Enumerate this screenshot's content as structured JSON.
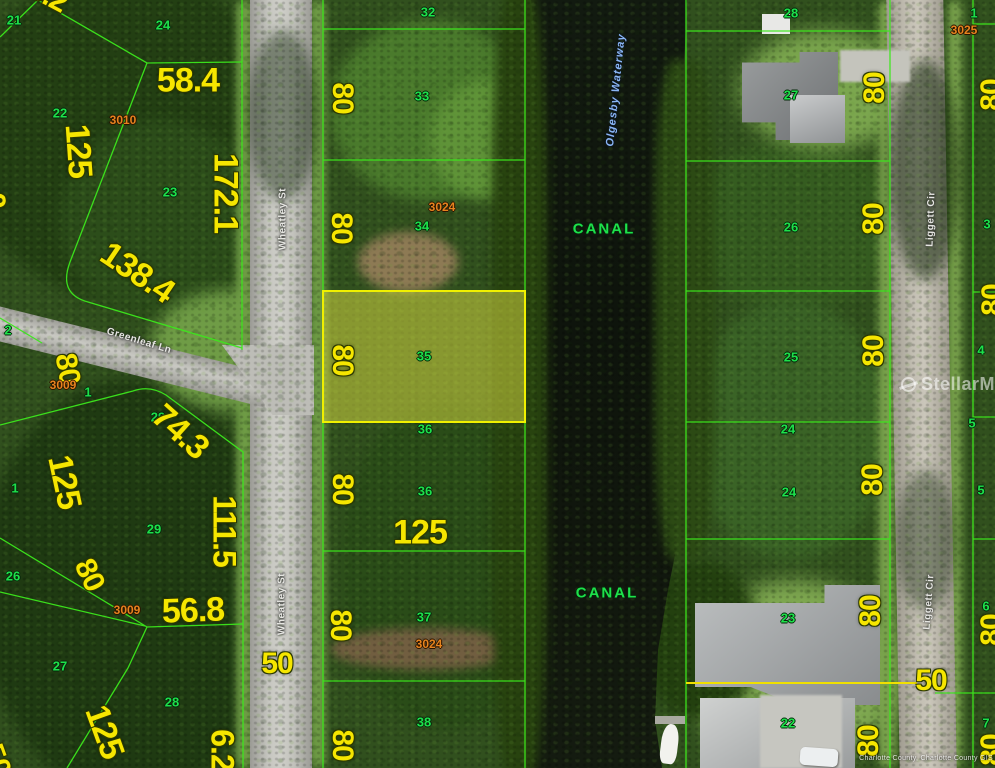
{
  "map": {
    "title": "aerial parcel map",
    "watermark": {
      "text": "StellarMLS"
    },
    "attribution": "Charlotte County, Charlotte County GIS",
    "waterway_name": "Olgesby Waterway",
    "highlight": {
      "lot": "35",
      "fill": "#e8e846",
      "border": "#f0f000"
    },
    "colors": {
      "dimension_text": "#f6e600",
      "lot_number_text": "#1de14b",
      "parcel_id_text": "#e6831e",
      "boundary_line": "#3ce81c",
      "highlight_line": "#f0e000",
      "waterway_text": "#8ab5f5"
    },
    "streets": [
      {
        "name": "Wheatley St"
      },
      {
        "name": "Greenleaf Ln"
      },
      {
        "name": "Liggett Cir"
      }
    ],
    "labels": [
      {
        "t": "21",
        "x": 14,
        "y": 20,
        "r": 0,
        "c": "lot"
      },
      {
        "t": "24",
        "x": 163,
        "y": 25,
        "r": 0,
        "c": "lot"
      },
      {
        "t": "22",
        "x": 60,
        "y": 113,
        "r": 0,
        "c": "lot"
      },
      {
        "t": "23",
        "x": 170,
        "y": 192,
        "r": 0,
        "c": "lot"
      },
      {
        "t": "2",
        "x": 8,
        "y": 330,
        "r": 0,
        "c": "lot"
      },
      {
        "t": "1",
        "x": 88,
        "y": 392,
        "r": 0,
        "c": "lot"
      },
      {
        "t": "29",
        "x": 158,
        "y": 417,
        "r": 0,
        "c": "lot"
      },
      {
        "t": "1",
        "x": 15,
        "y": 488,
        "r": 0,
        "c": "lot"
      },
      {
        "t": "29",
        "x": 154,
        "y": 529,
        "r": 0,
        "c": "lot"
      },
      {
        "t": "26",
        "x": 13,
        "y": 576,
        "r": 0,
        "c": "lot"
      },
      {
        "t": "27",
        "x": 60,
        "y": 666,
        "r": 0,
        "c": "lot"
      },
      {
        "t": "28",
        "x": 172,
        "y": 702,
        "r": 0,
        "c": "lot"
      },
      {
        "t": "32",
        "x": 428,
        "y": 12,
        "r": 0,
        "c": "lot"
      },
      {
        "t": "33",
        "x": 422,
        "y": 96,
        "r": 0,
        "c": "lot"
      },
      {
        "t": "34",
        "x": 422,
        "y": 226,
        "r": 0,
        "c": "lot"
      },
      {
        "t": "35",
        "x": 424,
        "y": 356,
        "r": 0,
        "c": "lot"
      },
      {
        "t": "36",
        "x": 425,
        "y": 429,
        "r": 0,
        "c": "lot"
      },
      {
        "t": "36",
        "x": 425,
        "y": 491,
        "r": 0,
        "c": "lot"
      },
      {
        "t": "37",
        "x": 424,
        "y": 617,
        "r": 0,
        "c": "lot"
      },
      {
        "t": "38",
        "x": 424,
        "y": 722,
        "r": 0,
        "c": "lot"
      },
      {
        "t": "28",
        "x": 791,
        "y": 13,
        "r": 0,
        "c": "lot"
      },
      {
        "t": "27",
        "x": 791,
        "y": 95,
        "r": 0,
        "c": "lot"
      },
      {
        "t": "26",
        "x": 791,
        "y": 227,
        "r": 0,
        "c": "lot"
      },
      {
        "t": "25",
        "x": 791,
        "y": 357,
        "r": 0,
        "c": "lot"
      },
      {
        "t": "24",
        "x": 788,
        "y": 429,
        "r": 0,
        "c": "lot"
      },
      {
        "t": "24",
        "x": 789,
        "y": 492,
        "r": 0,
        "c": "lot"
      },
      {
        "t": "23",
        "x": 788,
        "y": 618,
        "r": 0,
        "c": "lot"
      },
      {
        "t": "22",
        "x": 788,
        "y": 723,
        "r": 0,
        "c": "lot"
      },
      {
        "t": "1",
        "x": 974,
        "y": 13,
        "r": 0,
        "c": "lot"
      },
      {
        "t": "2",
        "x": 988,
        "y": 92,
        "r": 0,
        "c": "lot"
      },
      {
        "t": "3",
        "x": 987,
        "y": 224,
        "r": 0,
        "c": "lot"
      },
      {
        "t": "4",
        "x": 981,
        "y": 350,
        "r": 0,
        "c": "lot"
      },
      {
        "t": "5",
        "x": 972,
        "y": 423,
        "r": 0,
        "c": "lot"
      },
      {
        "t": "5",
        "x": 981,
        "y": 490,
        "r": 0,
        "c": "lot"
      },
      {
        "t": "6",
        "x": 986,
        "y": 606,
        "r": 0,
        "c": "lot"
      },
      {
        "t": "7",
        "x": 986,
        "y": 723,
        "r": 0,
        "c": "lot"
      },
      {
        "t": "5.2",
        "x": 48,
        "y": -4,
        "r": 28,
        "c": "dim",
        "s": 30
      },
      {
        "t": "58.4",
        "x": 188,
        "y": 81,
        "r": 0,
        "c": "dim",
        "s": 34
      },
      {
        "t": "125",
        "x": 78,
        "y": 151,
        "r": 86,
        "c": "dim",
        "s": 34
      },
      {
        "t": "172.1",
        "x": 225,
        "y": 193,
        "r": 90,
        "c": "dim",
        "s": 34
      },
      {
        "t": "138.4",
        "x": 137,
        "y": 273,
        "r": 34,
        "c": "dim",
        "s": 34
      },
      {
        "t": "0",
        "x": -6,
        "y": 200,
        "r": 90,
        "c": "dim",
        "s": 30
      },
      {
        "t": "80",
        "x": 67,
        "y": 369,
        "r": 80,
        "c": "dim",
        "s": 30
      },
      {
        "t": "74.3",
        "x": 180,
        "y": 432,
        "r": 42,
        "c": "dim",
        "s": 34
      },
      {
        "t": "125",
        "x": 64,
        "y": 482,
        "r": 78,
        "c": "dim",
        "s": 34
      },
      {
        "t": "111.5",
        "x": 224,
        "y": 531,
        "r": 90,
        "c": "dim",
        "s": 32
      },
      {
        "t": "80",
        "x": 89,
        "y": 575,
        "r": 64,
        "c": "dim",
        "s": 30
      },
      {
        "t": "56.8",
        "x": 193,
        "y": 611,
        "r": -2,
        "c": "dim",
        "s": 34
      },
      {
        "t": "125",
        "x": 104,
        "y": 732,
        "r": 70,
        "c": "dim",
        "s": 34
      },
      {
        "t": "6.2",
        "x": 222,
        "y": 750,
        "r": 90,
        "c": "dim",
        "s": 32
      },
      {
        "t": "50",
        "x": -4,
        "y": 760,
        "r": 70,
        "c": "dim",
        "s": 30
      },
      {
        "t": "50",
        "x": 277,
        "y": 664,
        "r": 0,
        "c": "dim",
        "s": 30
      },
      {
        "t": "80",
        "x": 342,
        "y": 98,
        "r": 90,
        "c": "dim",
        "s": 30
      },
      {
        "t": "80",
        "x": 341,
        "y": 228,
        "r": 90,
        "c": "dim",
        "s": 30
      },
      {
        "t": "80",
        "x": 342,
        "y": 360,
        "r": 90,
        "c": "dim",
        "s": 30
      },
      {
        "t": "80",
        "x": 342,
        "y": 489,
        "r": 90,
        "c": "dim",
        "s": 30
      },
      {
        "t": "80",
        "x": 340,
        "y": 625,
        "r": 90,
        "c": "dim",
        "s": 30
      },
      {
        "t": "80",
        "x": 342,
        "y": 745,
        "r": 90,
        "c": "dim",
        "s": 30
      },
      {
        "t": "125",
        "x": 420,
        "y": 533,
        "r": 0,
        "c": "dim",
        "s": 34
      },
      {
        "t": "80",
        "x": 875,
        "y": 88,
        "r": -90,
        "c": "dim",
        "s": 30
      },
      {
        "t": "80",
        "x": 874,
        "y": 219,
        "r": -90,
        "c": "dim",
        "s": 30
      },
      {
        "t": "80",
        "x": 874,
        "y": 351,
        "r": -90,
        "c": "dim",
        "s": 30
      },
      {
        "t": "80",
        "x": 873,
        "y": 480,
        "r": -90,
        "c": "dim",
        "s": 30
      },
      {
        "t": "80",
        "x": 871,
        "y": 611,
        "r": -90,
        "c": "dim",
        "s": 30
      },
      {
        "t": "80",
        "x": 869,
        "y": 741,
        "r": -90,
        "c": "dim",
        "s": 30
      },
      {
        "t": "50",
        "x": 931,
        "y": 681,
        "r": 0,
        "c": "dim",
        "s": 30
      },
      {
        "t": "80",
        "x": 992,
        "y": 95,
        "r": -90,
        "c": "dim",
        "s": 30
      },
      {
        "t": "80",
        "x": 993,
        "y": 300,
        "r": -90,
        "c": "dim",
        "s": 30
      },
      {
        "t": "80",
        "x": 992,
        "y": 630,
        "r": -90,
        "c": "dim",
        "s": 30
      },
      {
        "t": "80",
        "x": 992,
        "y": 750,
        "r": -90,
        "c": "dim",
        "s": 30
      },
      {
        "t": "3010",
        "x": 123,
        "y": 120,
        "r": 0,
        "c": "pid"
      },
      {
        "t": "3024",
        "x": 442,
        "y": 207,
        "r": 0,
        "c": "pid"
      },
      {
        "t": "3009",
        "x": 63,
        "y": 385,
        "r": 0,
        "c": "pid"
      },
      {
        "t": "3009",
        "x": 127,
        "y": 610,
        "r": 0,
        "c": "pid"
      },
      {
        "t": "3024",
        "x": 429,
        "y": 644,
        "r": 0,
        "c": "pid"
      },
      {
        "t": "3025",
        "x": 964,
        "y": 30,
        "r": 0,
        "c": "pid"
      },
      {
        "t": "CANAL",
        "x": 604,
        "y": 229,
        "r": 0,
        "c": "canal"
      },
      {
        "t": "CANAL",
        "x": 607,
        "y": 593,
        "r": 0,
        "c": "canal"
      },
      {
        "t": "Wheatley St",
        "x": 283,
        "y": 219,
        "r": -90,
        "c": "street"
      },
      {
        "t": "Wheatley St",
        "x": 282,
        "y": 604,
        "r": -90,
        "c": "street"
      },
      {
        "t": "Greenleaf Ln",
        "x": 139,
        "y": 341,
        "r": 17,
        "c": "street"
      },
      {
        "t": "Liggett Cir",
        "x": 931,
        "y": 219,
        "r": -88,
        "c": "street"
      },
      {
        "t": "Liggett Cir",
        "x": 929,
        "y": 602,
        "r": -86,
        "c": "street"
      },
      {
        "t": "Olgesby Waterway",
        "x": 616,
        "y": 90,
        "r": -84,
        "c": "water"
      }
    ]
  }
}
